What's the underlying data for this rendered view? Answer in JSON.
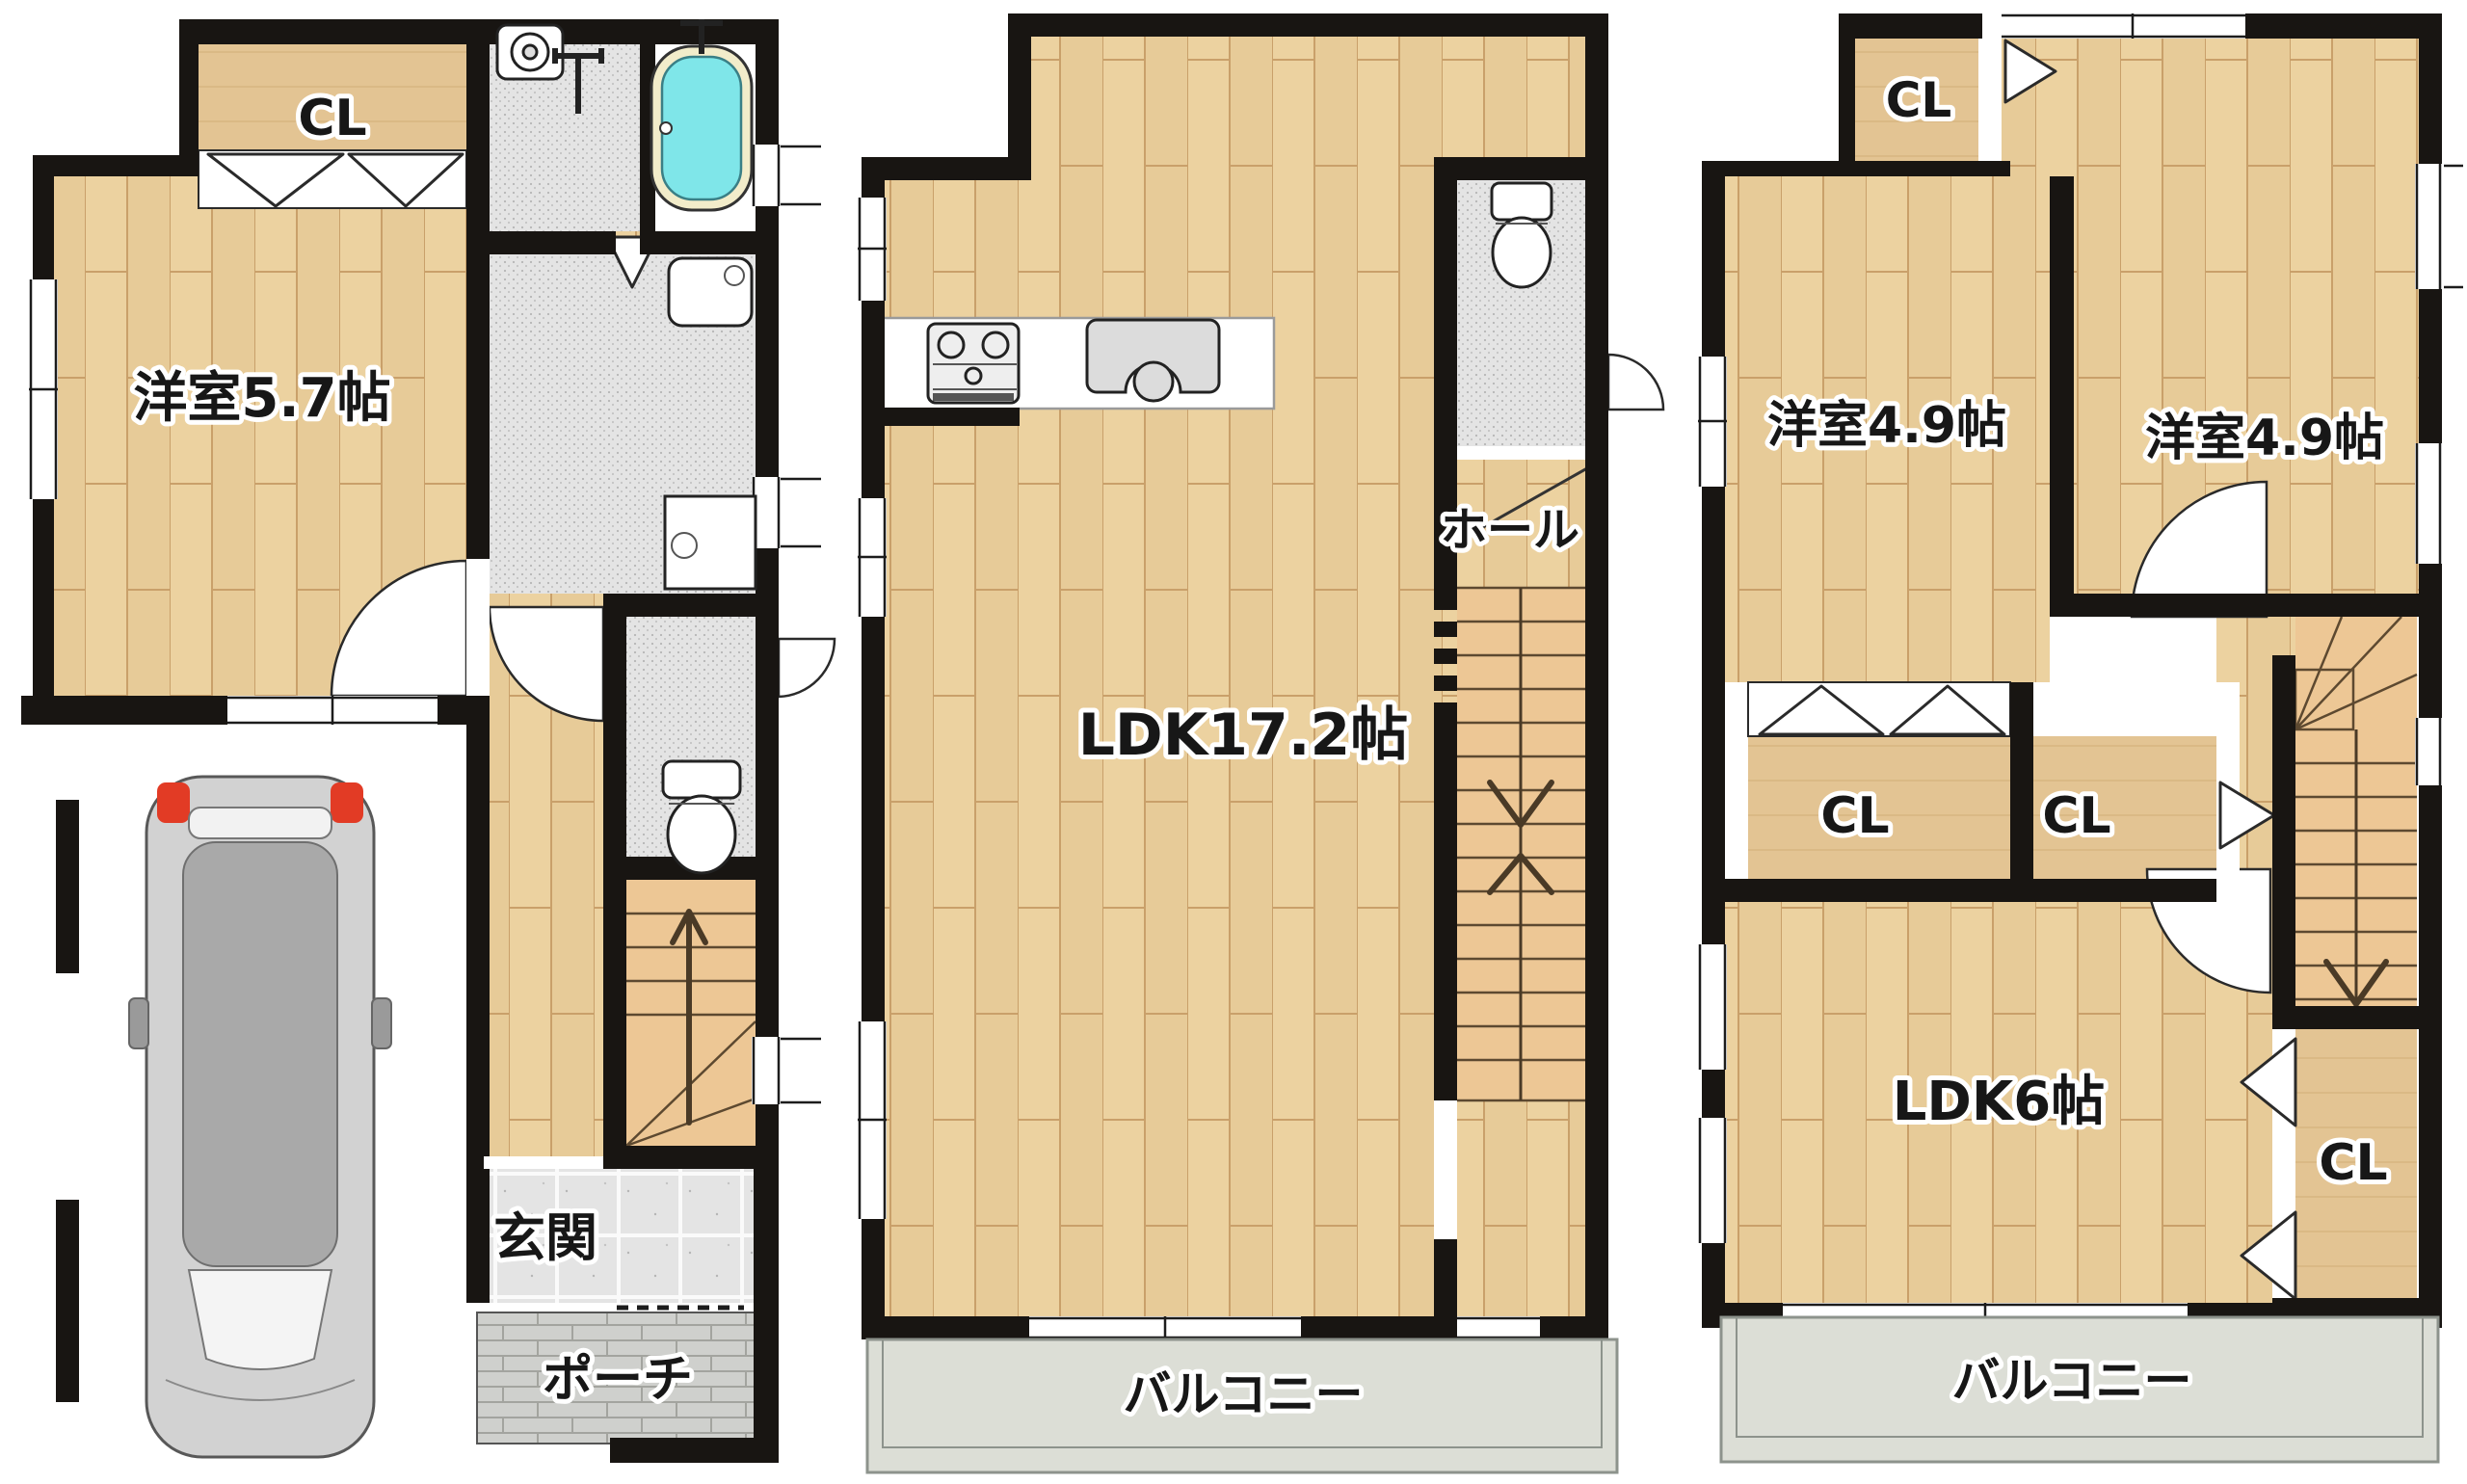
{
  "page": {
    "type": "real-estate floor plan, 3 stacked floor plans",
    "background": "#ffffff"
  },
  "labels": {
    "floor1": {
      "closet": "CL",
      "bedroom": "洋室5.7帖",
      "entrance": "玄関",
      "porch": "ポーチ"
    },
    "floor2": {
      "ldk": "LDK17.2帖",
      "hall": "ホール",
      "balcony": "バルコニー"
    },
    "floor3": {
      "closet_top": "CL",
      "bedroom_left": "洋室4.9帖",
      "bedroom_right": "洋室4.9帖",
      "closet_left": "CL",
      "closet_center": "CL",
      "ldk": "LDK6帖",
      "closet_right": "CL",
      "balcony": "バルコニー"
    }
  },
  "fixtures": [
    "car-icon",
    "bathtub-icon",
    "washing-machine-icon",
    "faucet-icon",
    "vanity-sink-icon",
    "wash-counter-icon",
    "toilet-icon",
    "stove-icon",
    "kitchen-sink-icon",
    "stairs-up-arrow",
    "stairs-down-arrow",
    "door-swing-arc",
    "folding-door-triangle"
  ],
  "colors": {
    "wall": "#181512",
    "woodBase": "#ecd2a0",
    "woodLine": "#c9a06a",
    "clBase": "#e3c493",
    "clLine": "#caa56d",
    "stairBase": "#edc795",
    "treadLine": "#5d4930",
    "greyBase": "#e4e4e4",
    "speckDot": "#b5b5b5",
    "tileGrout": "#fafafa",
    "brickBase": "#cfd0cd",
    "brickLine": "#a3a49f",
    "balconyBase": "#dcded6",
    "balconyEdge": "#8d938c",
    "tubFill": "#7fe6e9",
    "tubRim": "#f2ecca",
    "fixtureStroke": "#222222",
    "labelFill": "#171717",
    "labelHalo": "#ffffff",
    "carBody": "#d2d2d2",
    "carRoof": "#a9a9a9",
    "carRed": "#e23b25"
  }
}
